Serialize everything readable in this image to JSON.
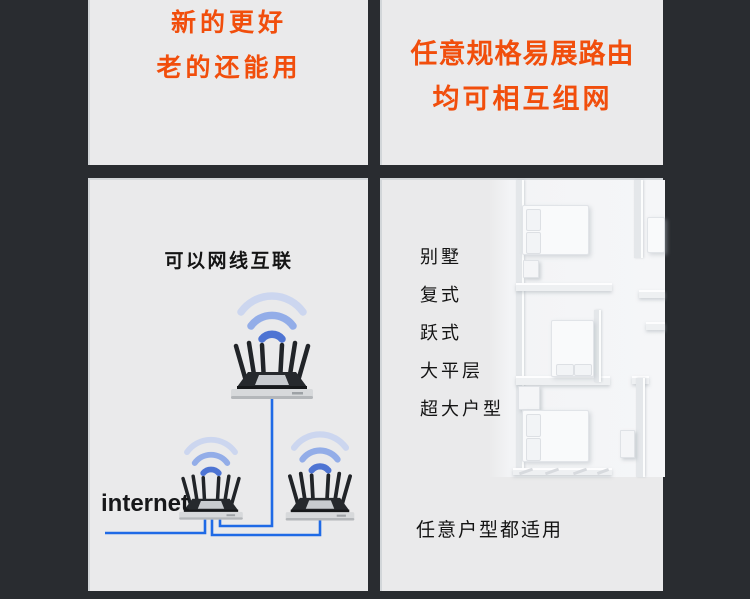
{
  "colors": {
    "background": "#292c30",
    "panel": "#eaeaeb",
    "accent_orange": "#f14e0c",
    "cable_blue": "#1f6ae6",
    "text_dark": "#141414"
  },
  "top_left_panel": {
    "line1": "新的更好",
    "line2": "老的还能用"
  },
  "top_right_panel": {
    "line1": "任意规格易展路由",
    "line2": "均可相互组网"
  },
  "bottom_left_panel": {
    "title": "可以网线互联",
    "internet_label": "internet",
    "icons": [
      "wifi-icon",
      "router-illustration",
      "ethernet-cable"
    ]
  },
  "bottom_right_panel": {
    "house_types": [
      "别墅",
      "复式",
      "跃式",
      "大平层",
      "超大户型"
    ],
    "footer": "任意户型都适用",
    "icons": [
      "floorplan-illustration"
    ]
  }
}
